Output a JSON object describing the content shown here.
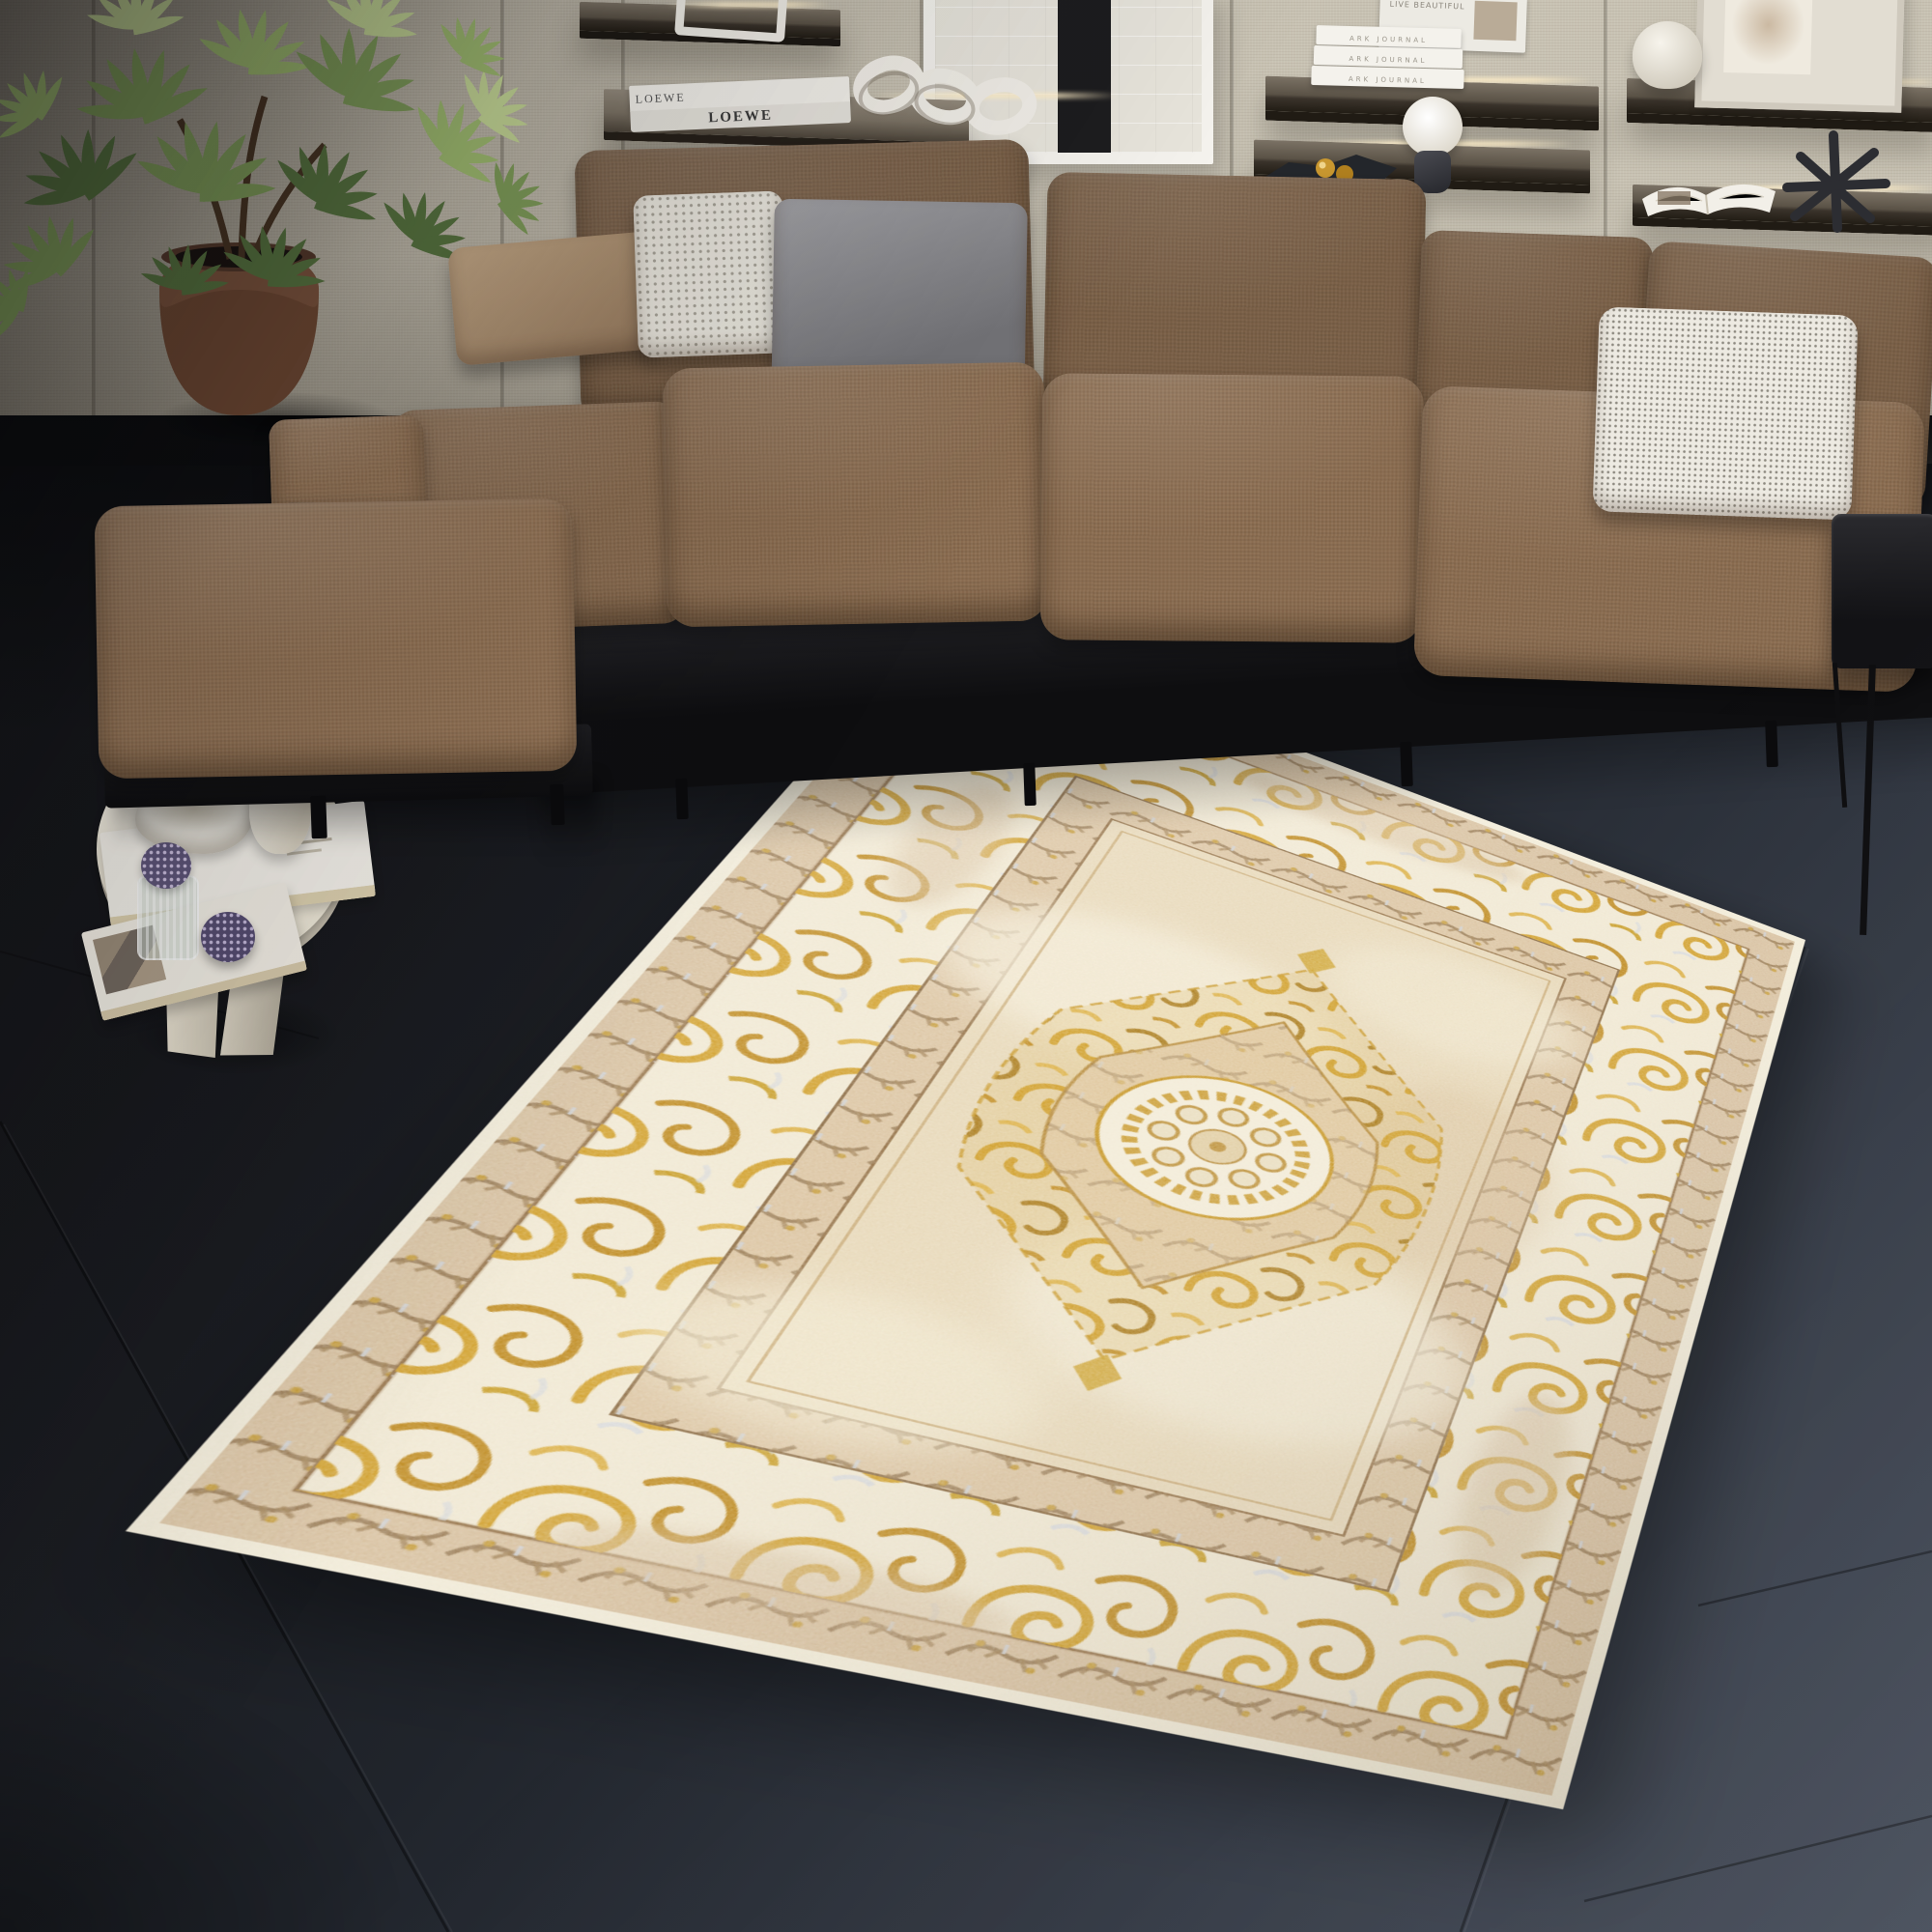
{
  "decor_text": {
    "loewe_book_spine": "LOEWE",
    "loewe_book_top": "LOEWE",
    "ark_journal_spine": "ARK JOURNAL",
    "leaning_book_cover": "LIVE BEAUTIFUL"
  },
  "palette": {
    "floor_dark": "#16171a",
    "floor_light": "#454c59",
    "wall_beige": "#c8c2b3",
    "sofa_brown": "#8a6c50",
    "pillow_gray": "#8b8b8f",
    "pillow_white": "#e9e6dd",
    "pillow_tan": "#bb9f7e",
    "rug_cream": "#f1e9d4",
    "rug_beige": "#d8c1a0",
    "rug_gold": "#d2a12d",
    "rug_field": "#e8d9ba",
    "plant_green": "#7d9a58",
    "pot_terracotta": "#7a5640",
    "table_marble": "#ece6d6",
    "shelf_wood": "#4a4339",
    "led_glow": "#ffeec8"
  }
}
